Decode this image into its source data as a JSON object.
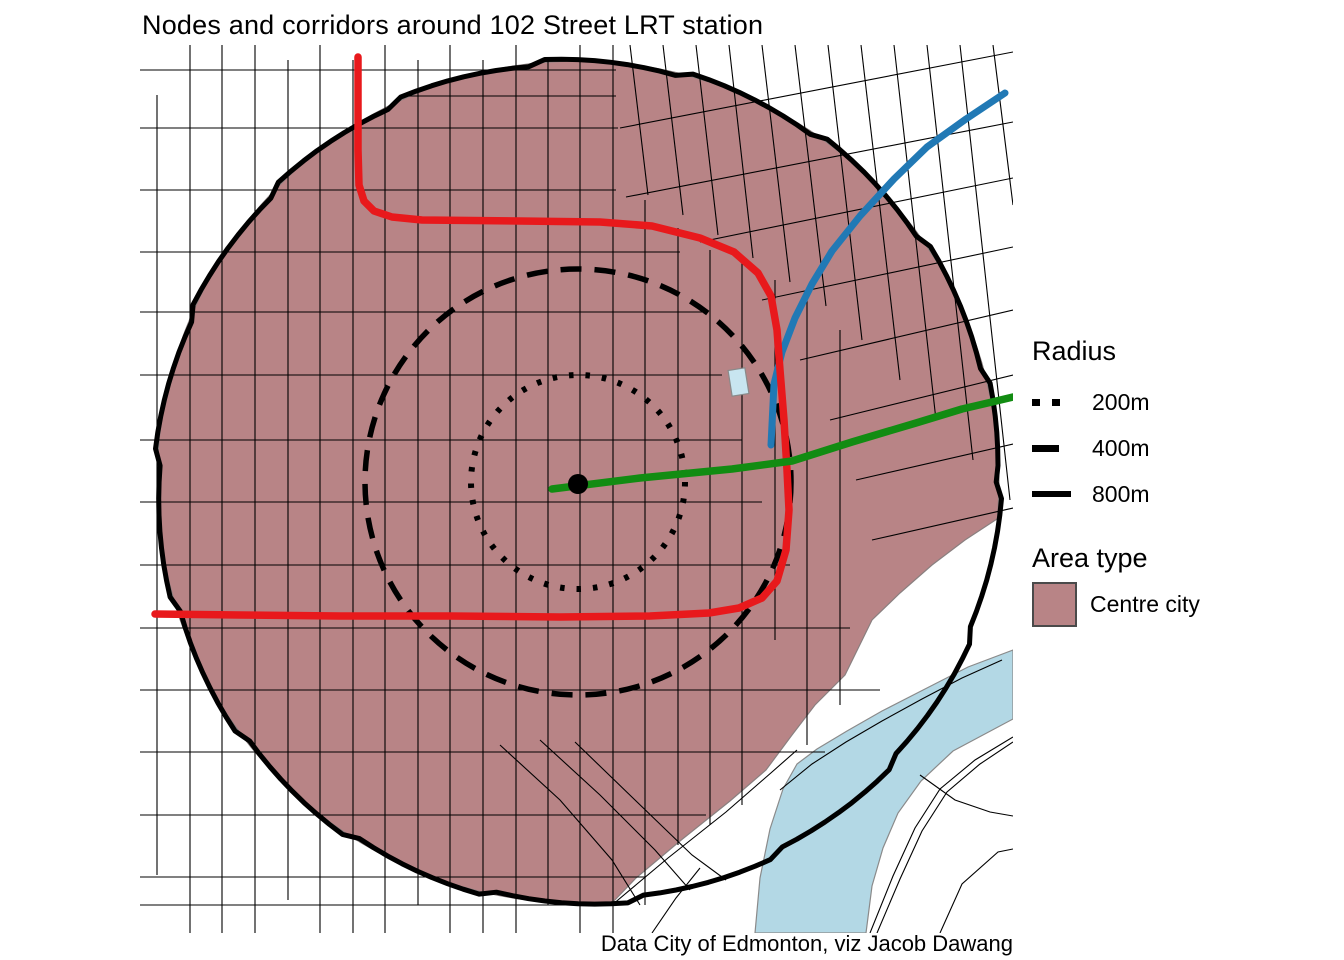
{
  "title": "Nodes and corridors around 102 Street LRT station",
  "caption": "Data City of Edmonton, viz Jacob Dawang",
  "colors": {
    "area": "#b88486",
    "area_edge": "#8a8080",
    "river": "#b3d8e5",
    "river_edge": "#8a8a8a",
    "building": "#c8e5f0",
    "street": "#000000",
    "circle": "#000000",
    "red": "#e8191c",
    "blue": "#2179b5",
    "green": "#128c12"
  },
  "legend": {
    "radius_title": "Radius",
    "items": [
      {
        "label": "200m",
        "style": "dotted"
      },
      {
        "label": "400m",
        "style": "dashed"
      },
      {
        "label": "800m",
        "style": "solid"
      }
    ],
    "area_title": "Area type",
    "area_items": [
      {
        "label": "Centre city"
      }
    ]
  },
  "map": {
    "circle": {
      "cx": 578,
      "cy": 482,
      "r": 421
    },
    "station": {
      "x": 578,
      "y": 484,
      "r": 10
    },
    "radius_circles": [
      {
        "name": "radius-200m-circle",
        "r": 107,
        "style": "dotted",
        "width": 6
      },
      {
        "name": "radius-400m-circle",
        "r": 213,
        "style": "dashed",
        "width": 5.5
      },
      {
        "name": "radius-800m-circle",
        "r": 421,
        "style": "solid",
        "width": 5
      }
    ],
    "area": {
      "arc_start": 86,
      "arc_end": 365,
      "cut": [
        [
          997,
          519
        ],
        [
          965,
          540
        ],
        [
          932,
          565
        ],
        [
          900,
          593
        ],
        [
          872,
          620
        ],
        [
          845,
          675
        ],
        [
          815,
          705
        ],
        [
          792,
          735
        ],
        [
          766,
          770
        ],
        [
          730,
          801
        ],
        [
          680,
          841
        ],
        [
          636,
          878
        ],
        [
          612,
          903
        ]
      ]
    },
    "river": "1013,650 968,667 925,689 882,711 847,731 817,749 797,764 783,789 770,829 760,878 755,933 866,933 872,886 883,848 898,813 921,781 953,751 1013,719",
    "building": {
      "x": 730,
      "y": 369,
      "w": 17,
      "h": 26,
      "angle": -9
    },
    "corridors": [
      {
        "name": "blue-corridor",
        "color": "blue",
        "width": 7,
        "points": "1005,93 966,119 927,147 894,179 860,216 832,251 812,284 795,318 782,352 774,384 771,445"
      },
      {
        "name": "red-corridor",
        "color": "red",
        "width": 7.5,
        "points": "358,57 358,150 359,185 364,201 374,211 392,217 422,220 520,221 600,222 652,226 700,238 734,252 758,273 771,296 777,330 780,370 784,420 787,470 789,510 786,550 777,581 762,598 739,608 709,613 650,616 560,617 450,616 340,616 240,615 155,614"
      },
      {
        "name": "green-corridor",
        "color": "green",
        "width": 7.5,
        "points": "552,489 640,478 732,469 792,461 852,442 916,423 962,409 992,402 1013,397"
      }
    ],
    "streets": [
      "157,95 157,875",
      "190,45 190,933",
      "222,45 222,933",
      "255,45 255,933",
      "288,60 288,900",
      "320,45 320,933",
      "353,60 353,933",
      "385,45 385,933",
      "418,60 418,905",
      "450,45 450,933",
      "483,60 483,933",
      "516,45 516,933",
      "548,60 548,905",
      "580,45 580,933",
      "613,45 613,933",
      "645,200 645,905",
      "678,228 678,845",
      "710,250 710,825",
      "742,262 742,805",
      "775,280 775,640",
      "807,300 807,745",
      "840,330 840,705",
      "140,70 616,70",
      "400,96 616,96",
      "140,128 618,128",
      "140,190 616,190",
      "140,252 680,252",
      "140,312 702,312",
      "140,375 722,375",
      "140,440 742,440",
      "140,502 762,502",
      "140,565 790,565",
      "140,628 850,628",
      "140,690 880,690",
      "140,752 825,752",
      "140,815 706,815",
      "140,877 646,877",
      "140,905 600,905",
      "630,45 648,195",
      "663,45 683,215",
      "696,45 718,235",
      "729,45 753,258",
      "762,45 790,282",
      "795,45 826,306",
      "828,45 862,340",
      "861,45 900,380",
      "894,45 936,420",
      "927,45 973,460",
      "960,45 1010,500",
      "993,45 1013,205",
      "620,128 1013,52",
      "626,197 1013,122",
      "700,242 1013,178",
      "762,300 1013,247",
      "800,360 1013,310",
      "830,420 1013,375",
      "856,480 1013,444",
      "872,540 1013,508",
      "612,905 668,858 726,812 772,772 797,750",
      "780,790 812,764 846,742 882,721 922,699 962,678 1002,660",
      "870,933 893,876 915,828 940,789 975,760 1013,737",
      "877,933 900,879 922,831 947,792 980,764 1013,742",
      "940,933 962,884 998,852 1013,849",
      "920,775 955,800 990,812 1013,816",
      "652,933 676,898 700,868",
      "500,745 560,800 612,860 640,905",
      "540,740 600,795 655,850 690,890",
      "575,742 635,800 692,855 726,880"
    ]
  }
}
